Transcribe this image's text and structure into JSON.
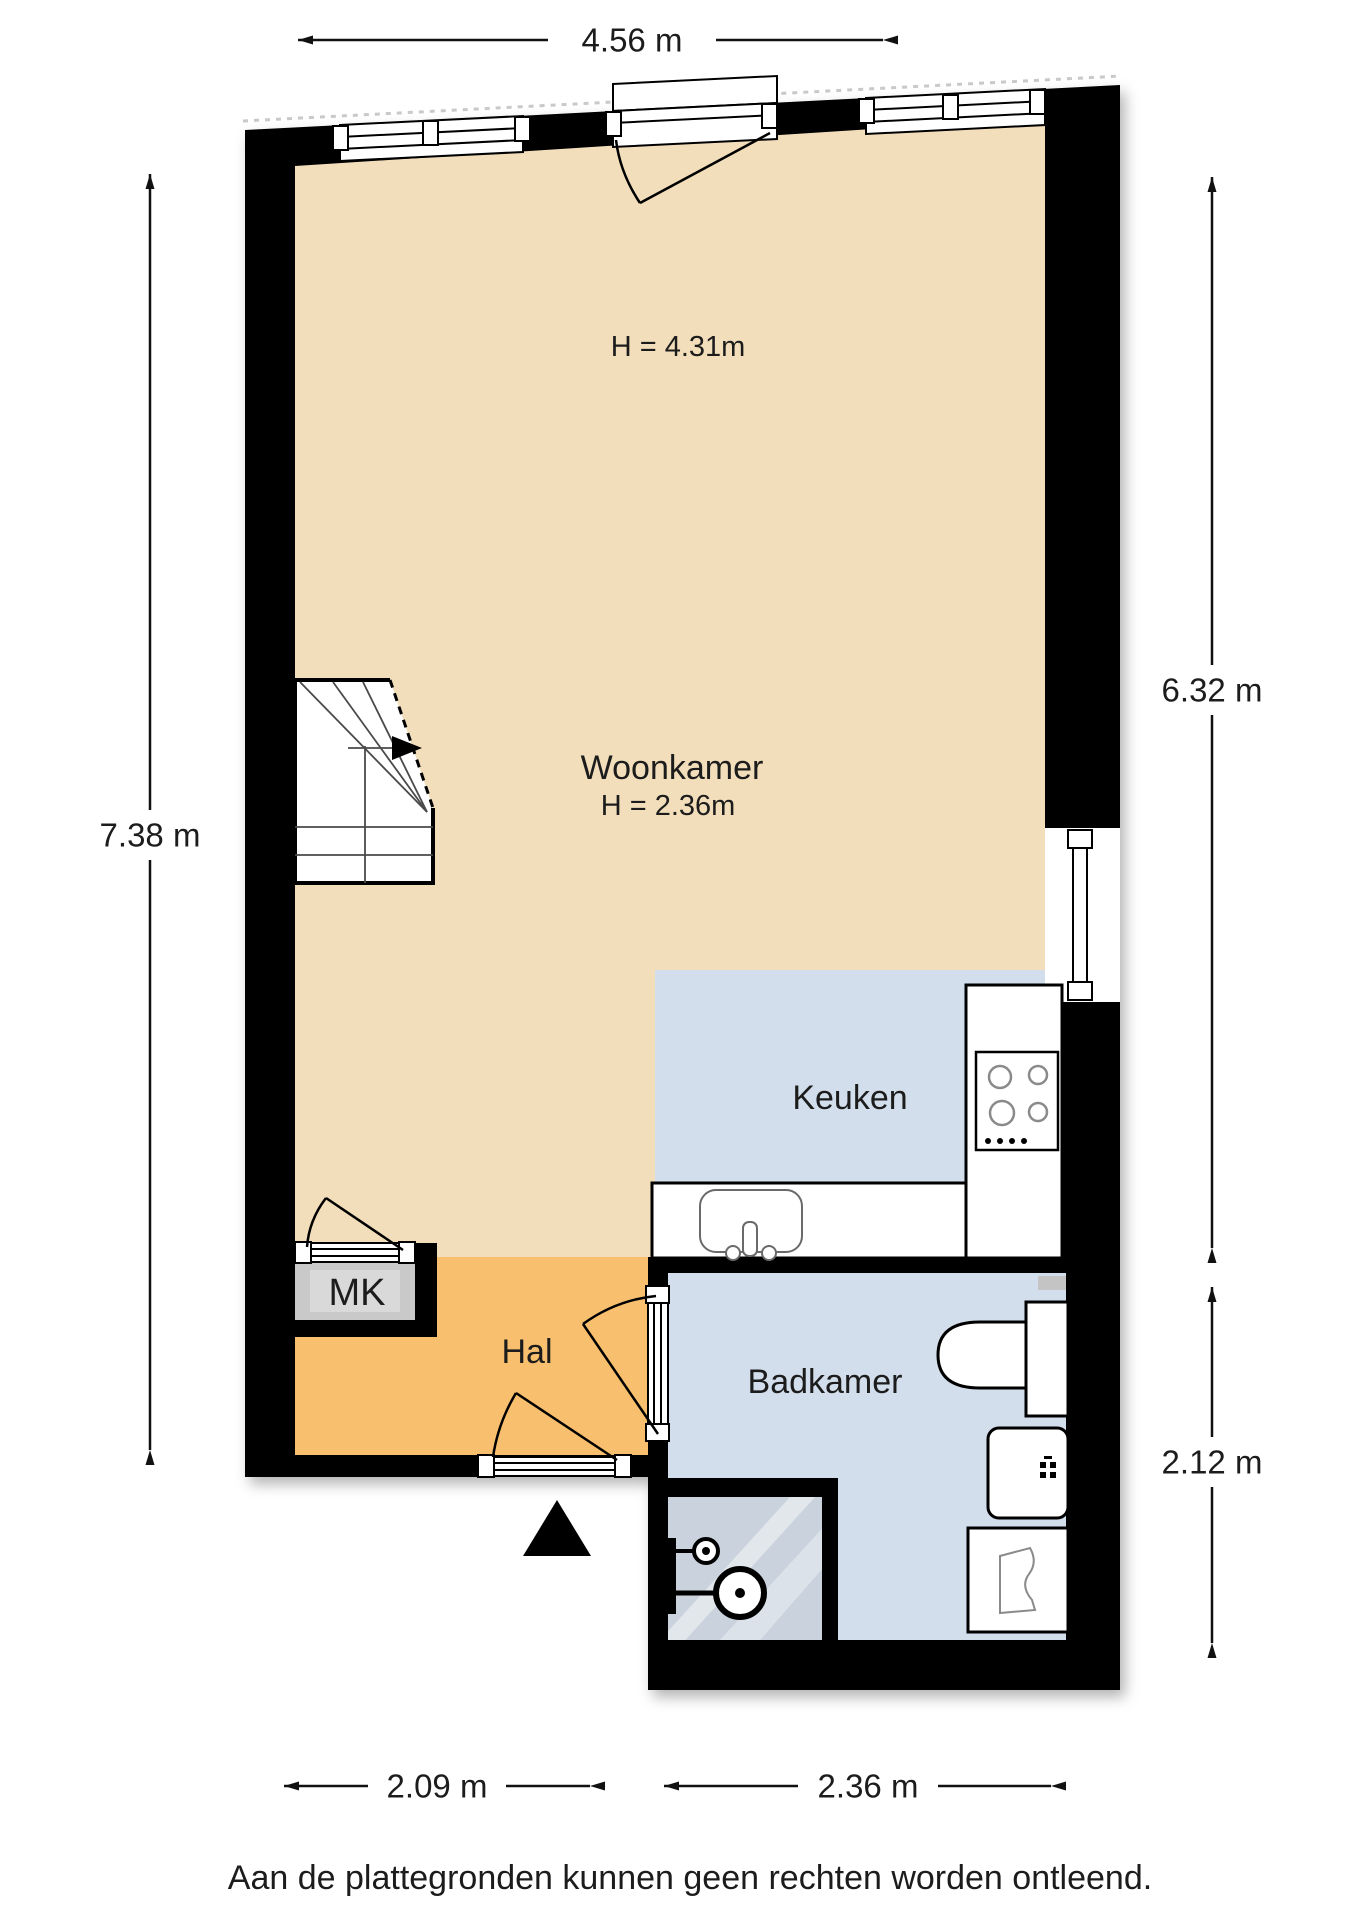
{
  "floorplan": {
    "rooms": {
      "woonkamer": {
        "label": "Woonkamer",
        "height_note": "H = 2.36m",
        "ceiling_note": "H = 4.31m"
      },
      "keuken": {
        "label": "Keuken"
      },
      "badkamer": {
        "label": "Badkamer"
      },
      "hal": {
        "label": "Hal"
      },
      "mk": {
        "label": "MK"
      }
    },
    "dimensions": {
      "top_width": "4.56 m",
      "left_height": "7.38 m",
      "right_height_upper": "6.32 m",
      "right_height_lower": "2.12 m",
      "bottom_left_width": "2.09 m",
      "bottom_right_width": "2.36 m"
    },
    "disclaimer": "Aan de plattegronden kunnen geen rechten worden ontleend.",
    "colors": {
      "woonkamer": "#f2deba",
      "hal": "#f8c06e",
      "keuken": "#d2deeb",
      "badkamer": "#d2deeb",
      "shower": "#cad3dd",
      "mk_closet": "#c9c9c9",
      "wall": "#000000"
    }
  }
}
